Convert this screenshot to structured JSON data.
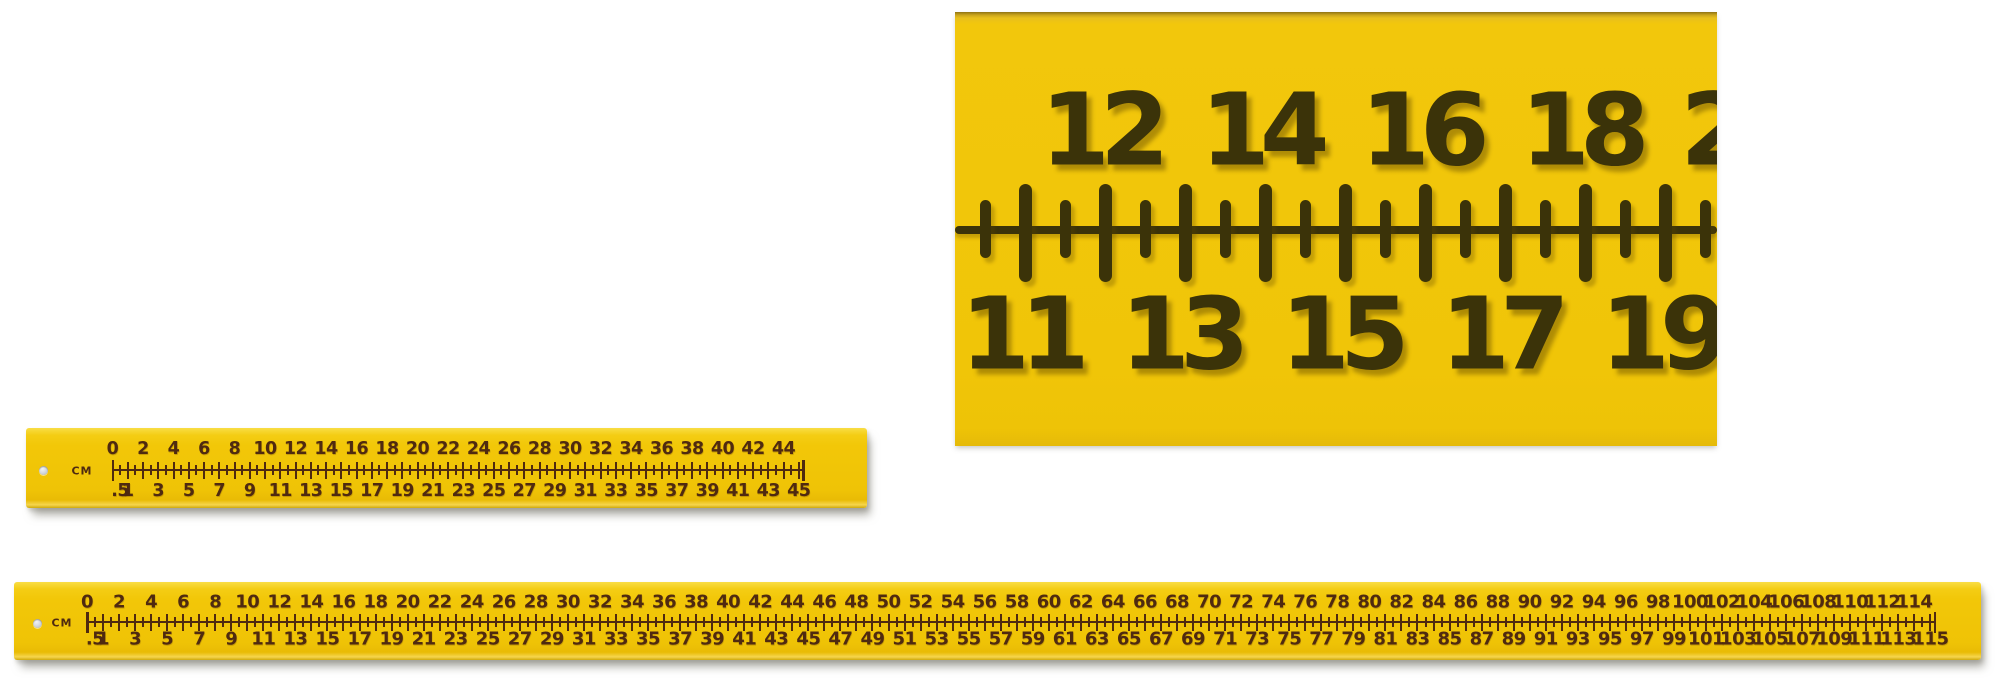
{
  "page": {
    "background": "#ffffff"
  },
  "colors": {
    "ruler_yellow": "#f2c708",
    "closeup_mark": "#3b3309",
    "small_mark": "#4f2a10",
    "hole_gray": "#c9ced5"
  },
  "closeup": {
    "top_labels": [
      "12",
      "14",
      "16",
      "18",
      "20"
    ],
    "bottom_labels": [
      "11",
      "13",
      "15",
      "17",
      "19"
    ]
  },
  "rulers": [
    {
      "id": "ruler45",
      "unit": "CM",
      "length_cm": 45,
      "top_labels": [
        "0",
        "2",
        "4",
        "6",
        "8",
        "10",
        "12",
        "14",
        "16",
        "18",
        "20",
        "22",
        "24",
        "26",
        "28",
        "30",
        "32",
        "34",
        "36",
        "38",
        "40",
        "42",
        "44"
      ],
      "bottom_labels": [
        ".5",
        "1",
        "3",
        "5",
        "7",
        "9",
        "11",
        "13",
        "15",
        "17",
        "19",
        "21",
        "23",
        "25",
        "27",
        "29",
        "31",
        "33",
        "35",
        "37",
        "39",
        "41",
        "43",
        "45"
      ]
    },
    {
      "id": "ruler115",
      "unit": "CM",
      "length_cm": 115,
      "top_labels": [
        "0",
        "2",
        "4",
        "6",
        "8",
        "10",
        "12",
        "14",
        "16",
        "18",
        "20",
        "22",
        "24",
        "26",
        "28",
        "30",
        "32",
        "34",
        "36",
        "38",
        "40",
        "42",
        "44",
        "46",
        "48",
        "50",
        "52",
        "54",
        "56",
        "58",
        "60",
        "62",
        "64",
        "66",
        "68",
        "70",
        "72",
        "74",
        "76",
        "78",
        "80",
        "82",
        "84",
        "86",
        "88",
        "90",
        "92",
        "94",
        "96",
        "98",
        "100",
        "102",
        "104",
        "106",
        "108",
        "110",
        "112",
        "114"
      ],
      "bottom_labels": [
        ".5",
        "1",
        "3",
        "5",
        "7",
        "9",
        "11",
        "13",
        "15",
        "17",
        "19",
        "21",
        "23",
        "25",
        "27",
        "29",
        "31",
        "33",
        "35",
        "37",
        "39",
        "41",
        "43",
        "45",
        "47",
        "49",
        "51",
        "53",
        "55",
        "57",
        "59",
        "61",
        "63",
        "65",
        "67",
        "69",
        "71",
        "73",
        "75",
        "77",
        "79",
        "81",
        "83",
        "85",
        "87",
        "89",
        "91",
        "93",
        "95",
        "97",
        "99",
        "101",
        "103",
        "105",
        "107",
        "109",
        "111",
        "113",
        "115"
      ]
    }
  ]
}
